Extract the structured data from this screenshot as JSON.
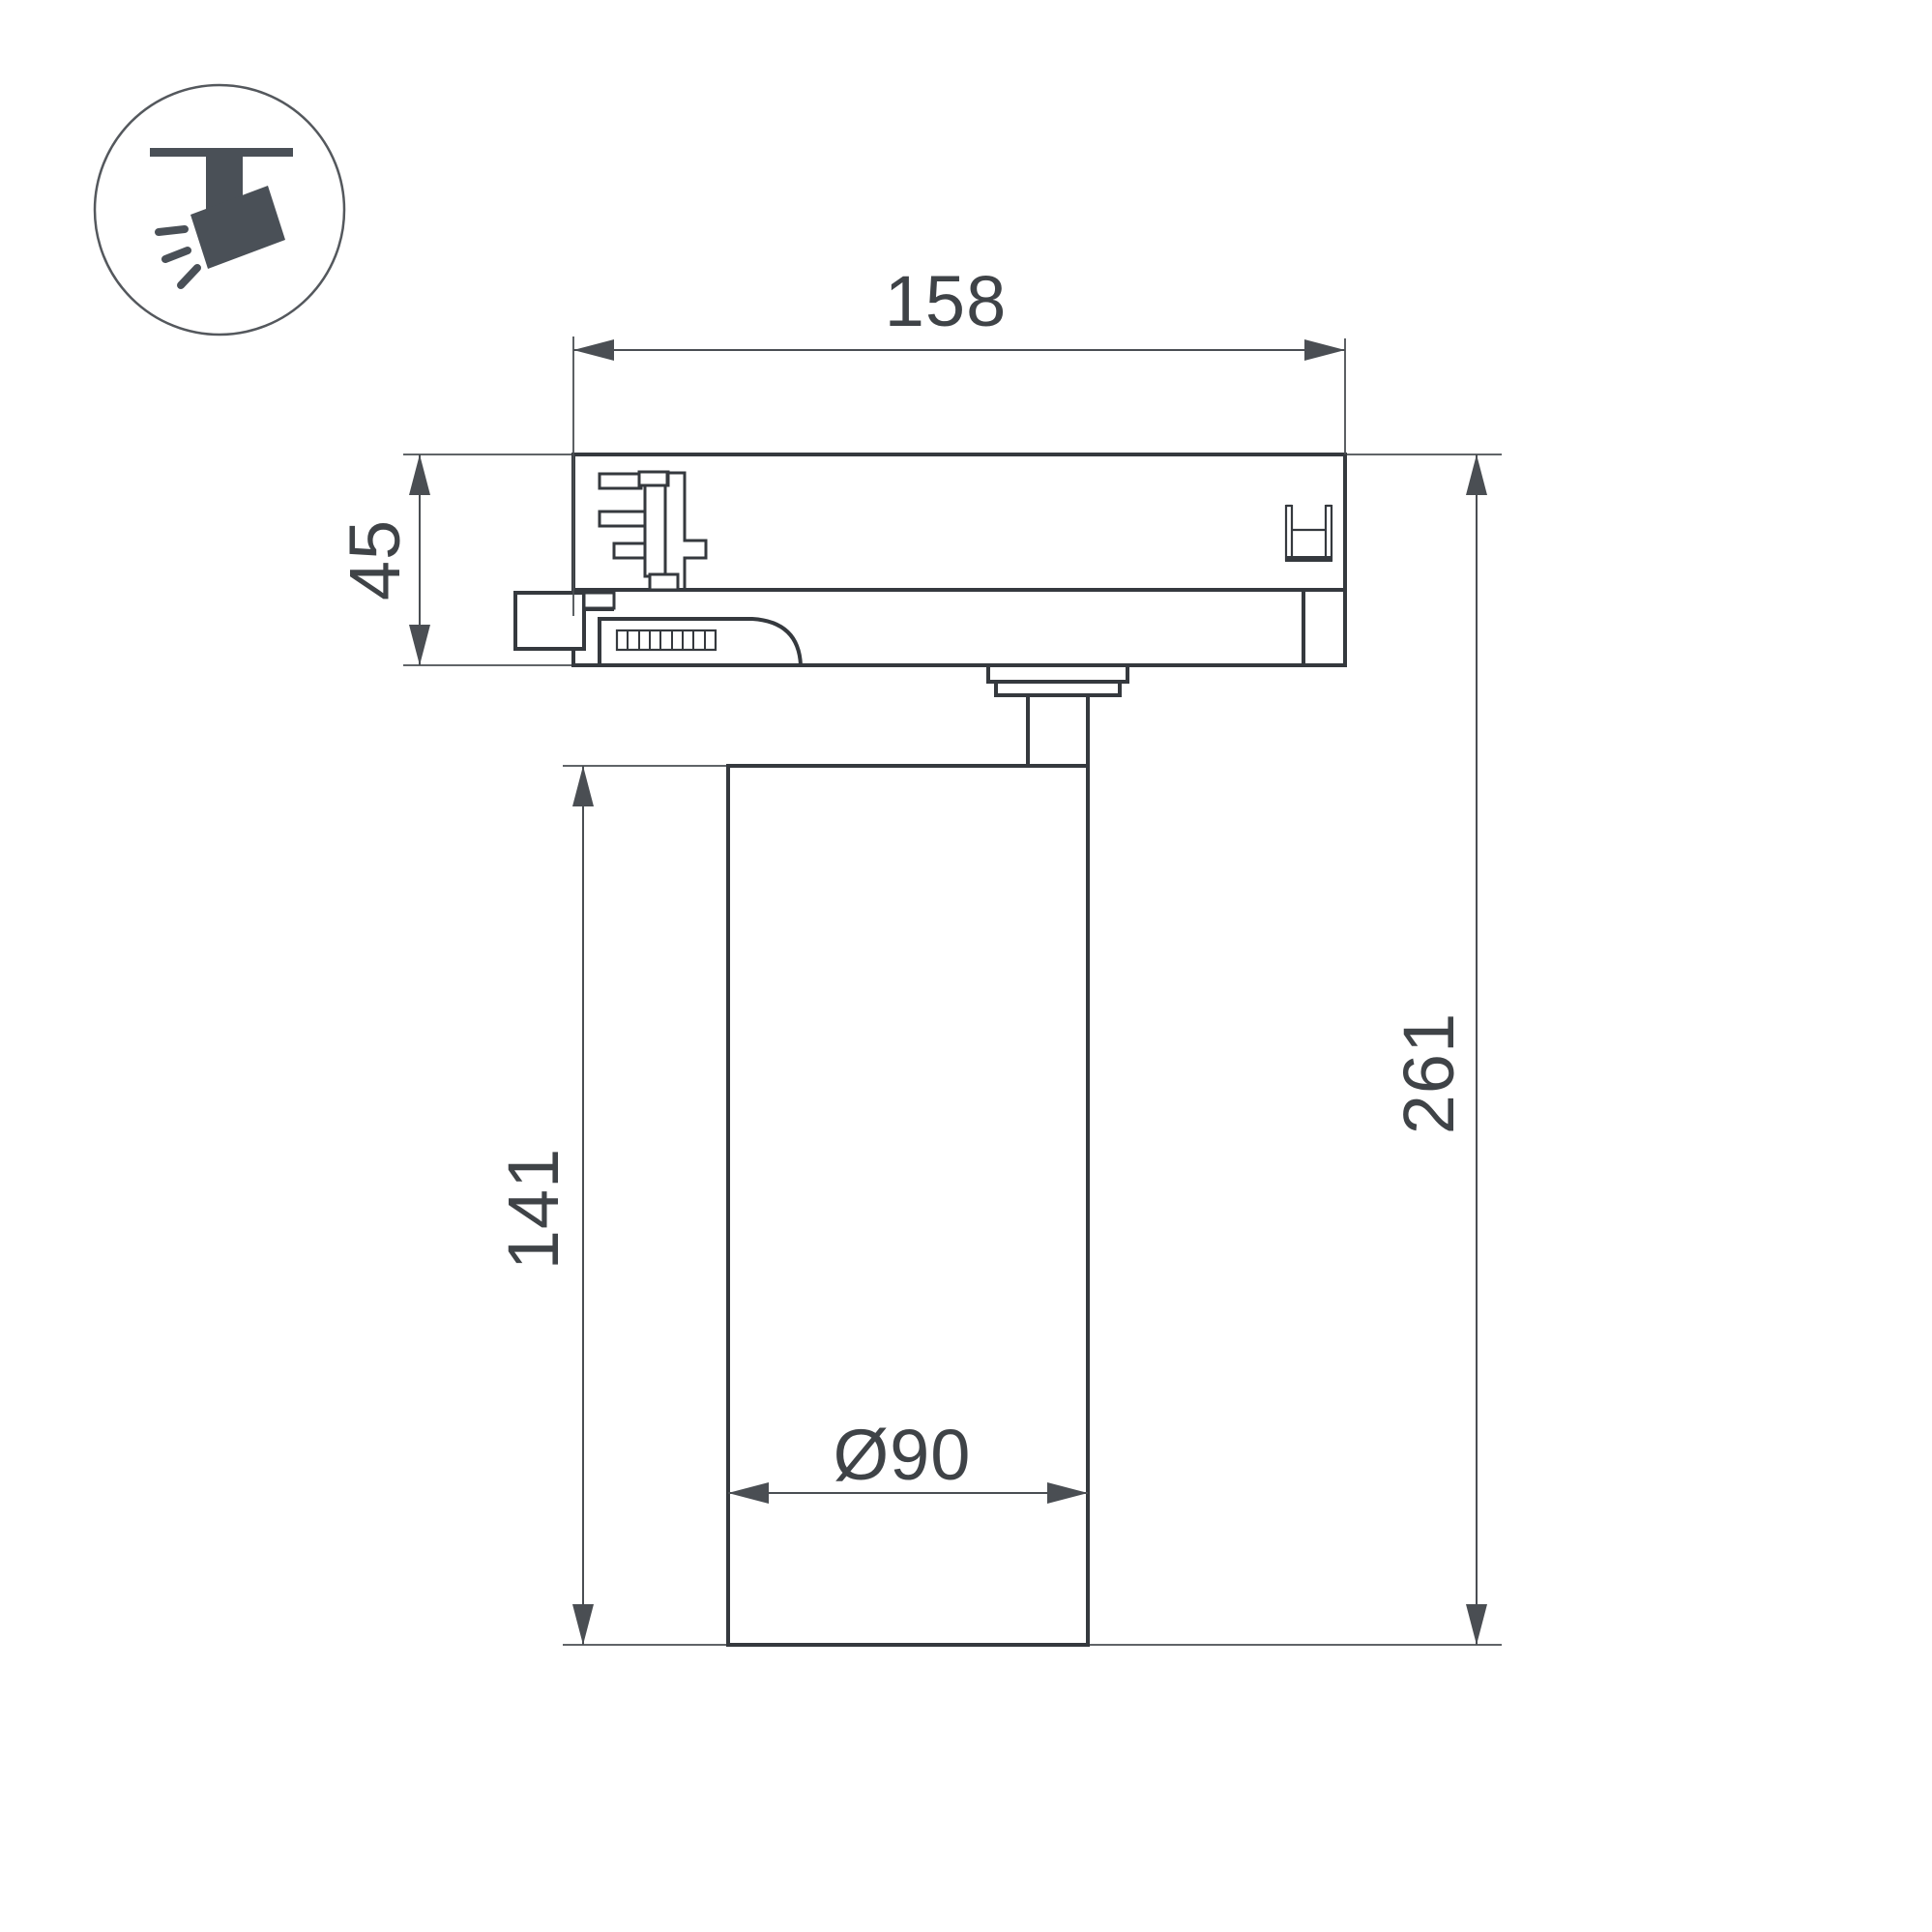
{
  "icon": {
    "name": "track-spotlight-icon",
    "description": "ceiling track with tilted spotlight head and light rays"
  },
  "labels": {
    "track_width": "158",
    "adapter_height": "45",
    "body_height": "141",
    "total_height": "261",
    "body_diameter": "Ø90"
  },
  "colors": {
    "outline": "#35393e",
    "dimension": "#4a4e53",
    "text": "#3f4347",
    "icon": "#4a5057",
    "icon_circle": "#54585d",
    "background": "#ffffff"
  }
}
